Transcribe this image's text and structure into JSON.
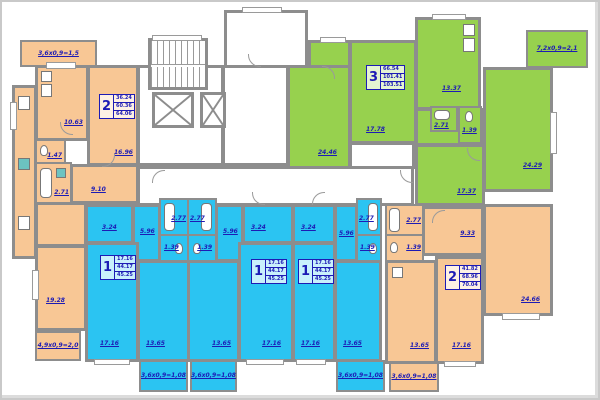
{
  "plan_title": "residential floor plan",
  "colors": {
    "one_room_apartment": "#2bc4f2",
    "two_room_apartment": "#f8c795",
    "three_room_apartment": "#97d14e",
    "walls": "#8d8d8d",
    "labels": "#1d1bb5"
  },
  "apartments": [
    {
      "id": "two-room-top-left",
      "label": {
        "count": "2",
        "living": "36.24",
        "total": "60.36",
        "total_with_balconies": "64.06"
      },
      "rooms": [
        {
          "name": "kitchen",
          "area": "10.63"
        },
        {
          "name": "living-room",
          "area": "16.96"
        },
        {
          "name": "hall",
          "area": "9.10"
        },
        {
          "name": "wc",
          "area": "1.47"
        },
        {
          "name": "bathroom",
          "area": "2.71"
        },
        {
          "name": "bedroom",
          "area": "19.28"
        }
      ],
      "balconies": [
        "3,6x0,9=1,5",
        "4,9x0,9=2,0"
      ]
    },
    {
      "id": "three-room-green",
      "label": {
        "count": "3",
        "living": "66.54",
        "total": "101.41",
        "total_with_balconies": "103.51"
      },
      "rooms": [
        {
          "name": "living-room",
          "area": "24.46"
        },
        {
          "name": "bedroom",
          "area": "17.78"
        },
        {
          "name": "kitchen",
          "area": "13.37"
        },
        {
          "name": "bathroom",
          "area": "2.71"
        },
        {
          "name": "wc",
          "area": "1.39"
        },
        {
          "name": "bedroom",
          "area": "17.37"
        },
        {
          "name": "bedroom",
          "area": "24.29"
        }
      ],
      "balconies": [
        "7,2x0,9=2,1"
      ]
    },
    {
      "id": "two-room-right",
      "label": {
        "count": "2",
        "living": "41.82",
        "total": "68.96",
        "total_with_balconies": "70.04"
      },
      "rooms": [
        {
          "name": "hall",
          "area": "9.33"
        },
        {
          "name": "bathroom",
          "area": "2.77"
        },
        {
          "name": "wc",
          "area": "1.39"
        },
        {
          "name": "kitchen",
          "area": "13.65"
        },
        {
          "name": "bedroom",
          "area": "17.16"
        },
        {
          "name": "living-room",
          "area": "24.66"
        }
      ],
      "balconies": [
        "3,6x0,9=1,08"
      ]
    },
    {
      "id": "one-room-a",
      "label": {
        "count": "1",
        "living": "17.16",
        "total": "44.17",
        "total_with_balconies": "45.25"
      },
      "rooms": [
        {
          "name": "hall",
          "area": "3.24"
        },
        {
          "name": "corridor",
          "area": "5.96"
        },
        {
          "name": "bathroom",
          "area": "2.77"
        },
        {
          "name": "wc",
          "area": "1.39"
        },
        {
          "name": "living-room",
          "area": "17.16"
        },
        {
          "name": "kitchen",
          "area": "13.65"
        }
      ],
      "balconies": [
        "3,6x0,9=1,08"
      ]
    },
    {
      "id": "one-room-b",
      "label": {
        "count": "1",
        "living": "17.16",
        "total": "44.17",
        "total_with_balconies": "45.25"
      },
      "rooms": [
        {
          "name": "hall",
          "area": "3.24"
        },
        {
          "name": "corridor",
          "area": "5.96"
        },
        {
          "name": "bathroom",
          "area": "2.77"
        },
        {
          "name": "wc",
          "area": "1.39"
        },
        {
          "name": "living-room",
          "area": "17.16"
        },
        {
          "name": "kitchen",
          "area": "13.65"
        }
      ],
      "balconies": [
        "3,6x0,9=1,08"
      ]
    },
    {
      "id": "one-room-c",
      "label": {
        "count": "1",
        "living": "17.16",
        "total": "44.17",
        "total_with_balconies": "45.25"
      },
      "rooms": [
        {
          "name": "hall",
          "area": "3.24"
        },
        {
          "name": "corridor",
          "area": "5.96"
        },
        {
          "name": "bathroom",
          "area": "2.77"
        },
        {
          "name": "wc",
          "area": "1.39"
        },
        {
          "name": "living-room",
          "area": "17.16"
        },
        {
          "name": "kitchen",
          "area": "13.65"
        }
      ],
      "balconies": [
        "3,6x0,9=1,08"
      ]
    }
  ]
}
